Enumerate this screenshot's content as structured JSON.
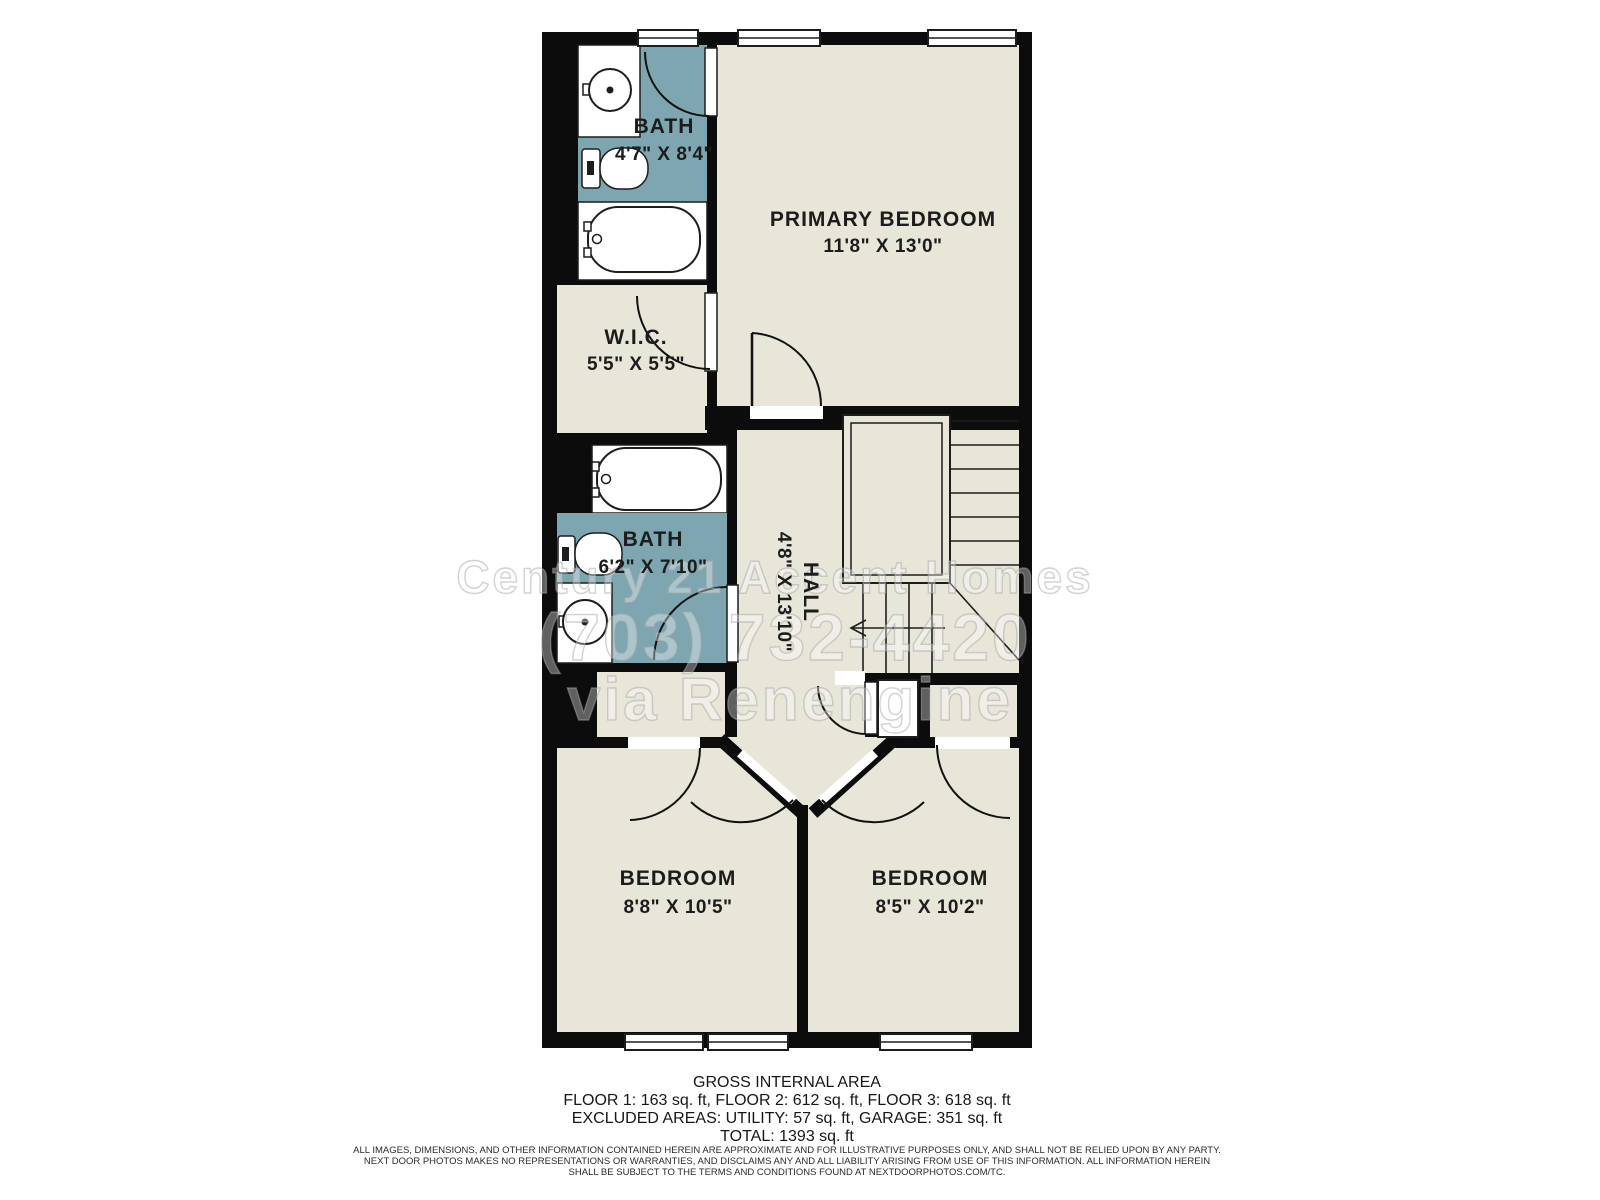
{
  "plan": {
    "rooms": {
      "bath_top": {
        "label": "BATH",
        "dims": "4'7\" X 8'4\""
      },
      "primary_bedroom": {
        "label": "PRIMARY BEDROOM",
        "dims": "11'8\" X 13'0\""
      },
      "wic": {
        "label": "W.I.C.",
        "dims": "5'5\" X 5'5\""
      },
      "bath_mid": {
        "label": "BATH",
        "dims": "6'2\" X 7'10\""
      },
      "hall": {
        "label": "HALL",
        "dims": "4'8\" X 13'10\""
      },
      "bedroom_left": {
        "label": "BEDROOM",
        "dims": "8'8\" X 10'5\""
      },
      "bedroom_right": {
        "label": "BEDROOM",
        "dims": "8'5\" X 10'2\""
      }
    },
    "watermark": {
      "line1": "Century 21 Accent Homes",
      "line2": "(703) 732-4420",
      "line3": "via Renengine"
    },
    "colors": {
      "wall": "#0c0c0c",
      "floor": "#e8e5d9",
      "wet_room": "#7da6b0",
      "outline": "#1d1d1d"
    }
  },
  "footer": {
    "title": "GROSS INTERNAL AREA",
    "line1": "FLOOR 1: 163 sq. ft, FLOOR 2: 612 sq. ft, FLOOR 3: 618 sq. ft",
    "line2": "EXCLUDED AREAS: UTILITY: 57 sq. ft, GARAGE: 351 sq. ft",
    "line3": "TOTAL: 1393 sq. ft"
  },
  "disclaimer": {
    "line1": "ALL IMAGES, DIMENSIONS, AND OTHER INFORMATION CONTAINED HEREIN ARE APPROXIMATE AND FOR ILLUSTRATIVE PURPOSES ONLY, AND SHALL NOT BE RELIED UPON BY ANY PARTY.",
    "line2": "NEXT DOOR PHOTOS MAKES NO REPRESENTATIONS OR WARRANTIES, AND DISCLAIMS ANY AND ALL LIABILITY ARISING FROM USE OF THIS INFORMATION. ALL INFORMATION HEREIN",
    "line3": "SHALL BE SUBJECT TO THE TERMS AND CONDITIONS FOUND AT NEXTDOORPHOTOS.COM/TC."
  }
}
